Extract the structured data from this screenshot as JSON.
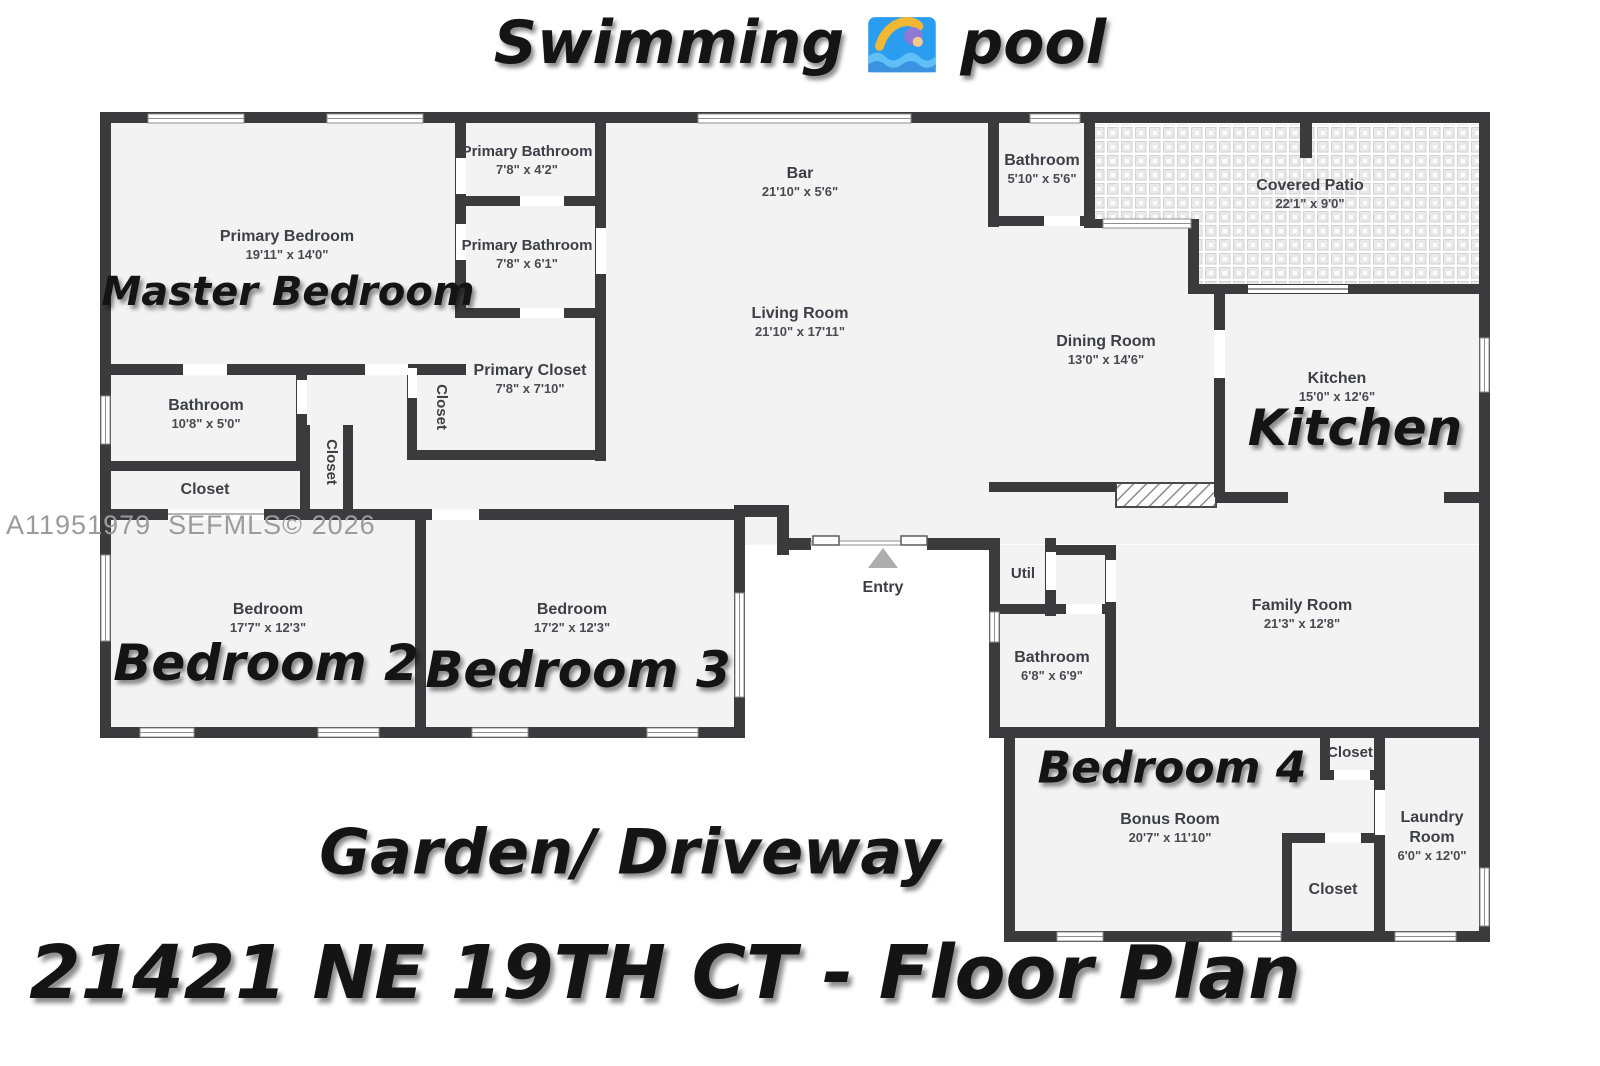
{
  "header": {
    "title_left": "Swimming",
    "title_right": "pool"
  },
  "footer": {
    "address_title": "21421 NE 19TH CT  - Floor Plan"
  },
  "annotations": {
    "garden": "Garden/ Driveway",
    "master_bedroom": "Master Bedroom",
    "kitchen": "Kitchen",
    "bedroom2": "Bedroom 2",
    "bedroom3": "Bedroom 3",
    "bedroom4": "Bedroom 4"
  },
  "watermark": "A11951979  SEFMLS© 2026",
  "colors": {
    "wall": "#3b3b3d",
    "floor": "#f3f3f4",
    "entry_arrow": "#adadad",
    "watermark": "#9b9b9b",
    "title_text": "#141414"
  },
  "rooms": {
    "primary_bedroom": {
      "name": "Primary Bedroom",
      "dims": "19'11\" x 14'0\""
    },
    "primary_bathroom_1": {
      "name": "Primary Bathroom",
      "dims": "7'8\" x 4'2\""
    },
    "primary_bathroom_2": {
      "name": "Primary Bathroom",
      "dims": "7'8\" x 6'1\""
    },
    "primary_closet": {
      "name": "Primary Closet",
      "dims": "7'8\" x 7'10\""
    },
    "hall_bathroom": {
      "name": "Bathroom",
      "dims": "10'8\" x 5'0\""
    },
    "hall_closet": {
      "name": "Closet"
    },
    "hall_closet_v1": {
      "name": "Closet"
    },
    "hall_closet_v2": {
      "name": "Closet"
    },
    "bar": {
      "name": "Bar",
      "dims": "21'10\" x 5'6\""
    },
    "living_room": {
      "name": "Living Room",
      "dims": "21'10\" x 17'11\""
    },
    "top_bathroom": {
      "name": "Bathroom",
      "dims": "5'10\" x 5'6\""
    },
    "covered_patio": {
      "name": "Covered Patio",
      "dims": "22'1\" x 9'0\""
    },
    "dining_room": {
      "name": "Dining Room",
      "dims": "13'0\" x 14'6\""
    },
    "kitchen": {
      "name": "Kitchen",
      "dims": "15'0\" x 12'6\""
    },
    "bedroom2": {
      "name": "Bedroom",
      "dims": "17'7\" x 12'3\""
    },
    "bedroom3": {
      "name": "Bedroom",
      "dims": "17'2\" x 12'3\""
    },
    "entry": {
      "name": "Entry"
    },
    "util": {
      "name": "Util"
    },
    "mid_bathroom": {
      "name": "Bathroom",
      "dims": "6'8\" x 6'9\""
    },
    "family_room": {
      "name": "Family Room",
      "dims": "21'3\" x 12'8\""
    },
    "bonus_room": {
      "name": "Bonus Room",
      "dims": "20'7\" x 11'10\""
    },
    "bedroom4_closet": {
      "name": "Closet"
    },
    "laundry_room": {
      "name_line1": "Laundry",
      "name_line2": "Room",
      "dims": "6'0\" x 12'0\""
    },
    "laundry_closet": {
      "name": "Closet"
    }
  }
}
